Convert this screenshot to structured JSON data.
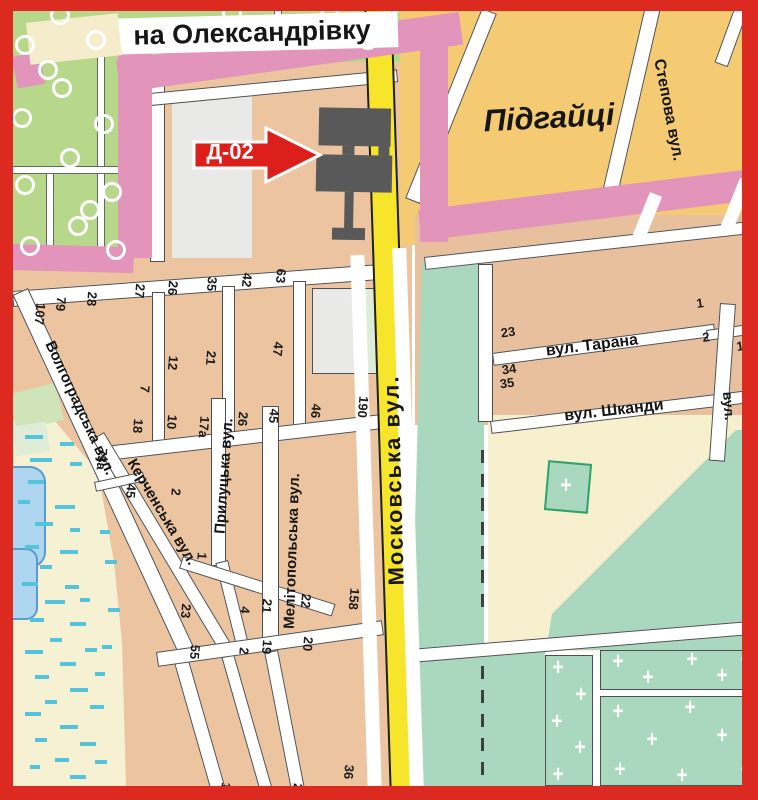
{
  "billboard": {
    "code": "Д-02"
  },
  "labels": [
    {
      "t": "на Олександрівку",
      "x": 252,
      "y": 33,
      "r": -1.5,
      "s": 27
    },
    {
      "t": "Підгайці",
      "x": 549,
      "y": 118,
      "r": -3,
      "s": 31,
      "i": 1
    },
    {
      "t": "Степова вул.",
      "x": 668,
      "y": 110,
      "r": 79,
      "s": 16
    },
    {
      "t": "Московська вул.",
      "x": 394,
      "y": 480,
      "r": -91.5,
      "s": 22,
      "ls": 2
    },
    {
      "t": "вул. Тарана",
      "x": 592,
      "y": 346,
      "r": -7,
      "s": 16
    },
    {
      "t": "вул. Шканди",
      "x": 614,
      "y": 411,
      "r": -6.5,
      "s": 16
    },
    {
      "t": "вул.",
      "x": 729,
      "y": 406,
      "r": 86,
      "s": 14
    },
    {
      "t": "Волгоградська вул.",
      "x": 80,
      "y": 408,
      "r": 65,
      "s": 15
    },
    {
      "t": "Керченська вул.",
      "x": 162,
      "y": 512,
      "r": 59,
      "s": 15
    },
    {
      "t": "Прилуцька вул.",
      "x": 224,
      "y": 476,
      "r": -86,
      "s": 15
    },
    {
      "t": "Мелітопольська вул.",
      "x": 292,
      "y": 551,
      "r": -88,
      "s": 15
    }
  ],
  "house_numbers": [
    {
      "t": "107",
      "x": 40,
      "y": 314
    },
    {
      "t": "79",
      "x": 61,
      "y": 304
    },
    {
      "t": "28",
      "x": 92,
      "y": 299
    },
    {
      "t": "27",
      "x": 140,
      "y": 291
    },
    {
      "t": "26",
      "x": 173,
      "y": 288
    },
    {
      "t": "35",
      "x": 212,
      "y": 284
    },
    {
      "t": "42",
      "x": 247,
      "y": 280
    },
    {
      "t": "63",
      "x": 281,
      "y": 276
    },
    {
      "t": "7",
      "x": 145,
      "y": 389
    },
    {
      "t": "12",
      "x": 173,
      "y": 363
    },
    {
      "t": "21",
      "x": 211,
      "y": 358
    },
    {
      "t": "47",
      "x": 278,
      "y": 349
    },
    {
      "t": "18",
      "x": 138,
      "y": 426
    },
    {
      "t": "10",
      "x": 172,
      "y": 422
    },
    {
      "t": "17а",
      "x": 204,
      "y": 427
    },
    {
      "t": "26",
      "x": 243,
      "y": 419
    },
    {
      "t": "45",
      "x": 274,
      "y": 416
    },
    {
      "t": "46",
      "x": 316,
      "y": 411
    },
    {
      "t": "190",
      "x": 363,
      "y": 407
    },
    {
      "t": "73а",
      "x": 102,
      "y": 459
    },
    {
      "t": "45",
      "x": 131,
      "y": 491
    },
    {
      "t": "2",
      "x": 176,
      "y": 492
    },
    {
      "t": "1",
      "x": 202,
      "y": 556
    },
    {
      "t": "23",
      "x": 186,
      "y": 611
    },
    {
      "t": "4",
      "x": 245,
      "y": 610
    },
    {
      "t": "21",
      "x": 267,
      "y": 606
    },
    {
      "t": "22",
      "x": 306,
      "y": 601
    },
    {
      "t": "158",
      "x": 354,
      "y": 599
    },
    {
      "t": "55",
      "x": 195,
      "y": 652
    },
    {
      "t": "2",
      "x": 244,
      "y": 651
    },
    {
      "t": "19",
      "x": 267,
      "y": 647
    },
    {
      "t": "20",
      "x": 308,
      "y": 644
    },
    {
      "t": "36",
      "x": 349,
      "y": 772
    },
    {
      "t": "1",
      "x": 226,
      "y": 786
    },
    {
      "t": "2",
      "x": 298,
      "y": 787
    },
    {
      "t": "23",
      "x": 508,
      "y": 332,
      "r": -8
    },
    {
      "t": "1",
      "x": 700,
      "y": 303,
      "r": -8
    },
    {
      "t": "2",
      "x": 706,
      "y": 337,
      "r": -8
    },
    {
      "t": "34",
      "x": 509,
      "y": 369,
      "r": -8
    },
    {
      "t": "35",
      "x": 507,
      "y": 383,
      "r": -8
    },
    {
      "t": "1",
      "x": 740,
      "y": 346,
      "r": -8
    }
  ],
  "decor": {
    "trees": [
      [
        25,
        45
      ],
      [
        60,
        15
      ],
      [
        96,
        40
      ],
      [
        22,
        118
      ],
      [
        62,
        88
      ],
      [
        104,
        124
      ],
      [
        25,
        185
      ],
      [
        70,
        158
      ],
      [
        112,
        192
      ],
      [
        30,
        246
      ],
      [
        78,
        226
      ],
      [
        116,
        250
      ],
      [
        48,
        70
      ],
      [
        90,
        210
      ],
      [
        185,
        30
      ],
      [
        232,
        13
      ],
      [
        280,
        36
      ],
      [
        330,
        16
      ],
      [
        368,
        40
      ]
    ],
    "marsh_dashes": [
      [
        25,
        435,
        18
      ],
      [
        60,
        442,
        14
      ],
      [
        30,
        458,
        22
      ],
      [
        70,
        462,
        12
      ],
      [
        28,
        480,
        16
      ],
      [
        18,
        500,
        12
      ],
      [
        55,
        505,
        20
      ],
      [
        35,
        522,
        18
      ],
      [
        70,
        528,
        10
      ],
      [
        25,
        545,
        14
      ],
      [
        60,
        550,
        18
      ],
      [
        100,
        530,
        10
      ],
      [
        40,
        565,
        12
      ],
      [
        105,
        560,
        12
      ],
      [
        22,
        582,
        16
      ],
      [
        65,
        585,
        14
      ],
      [
        45,
        600,
        20
      ],
      [
        80,
        598,
        10
      ],
      [
        108,
        608,
        12
      ],
      [
        30,
        618,
        14
      ],
      [
        70,
        622,
        16
      ],
      [
        102,
        645,
        10
      ],
      [
        50,
        638,
        12
      ],
      [
        25,
        650,
        18
      ],
      [
        85,
        648,
        12
      ],
      [
        60,
        662,
        16
      ],
      [
        35,
        675,
        14
      ],
      [
        95,
        672,
        10
      ],
      [
        70,
        688,
        18
      ],
      [
        45,
        700,
        12
      ],
      [
        25,
        712,
        16
      ],
      [
        90,
        705,
        14
      ],
      [
        60,
        725,
        18
      ],
      [
        35,
        738,
        12
      ],
      [
        80,
        742,
        16
      ],
      [
        55,
        758,
        14
      ],
      [
        30,
        765,
        10
      ],
      [
        95,
        760,
        12
      ],
      [
        70,
        775,
        16
      ],
      [
        45,
        786,
        10
      ]
    ],
    "crosses": [
      [
        566,
        486
      ],
      [
        558,
        668
      ],
      [
        581,
        695
      ],
      [
        557,
        722
      ],
      [
        580,
        748
      ],
      [
        558,
        775
      ],
      [
        618,
        662
      ],
      [
        648,
        678
      ],
      [
        692,
        660
      ],
      [
        722,
        676
      ],
      [
        746,
        660
      ],
      [
        618,
        712
      ],
      [
        690,
        708
      ],
      [
        748,
        712
      ],
      [
        652,
        740
      ],
      [
        722,
        736
      ],
      [
        620,
        770
      ],
      [
        682,
        776
      ],
      [
        746,
        770
      ]
    ]
  },
  "colors": {
    "frame": "#dc2a20",
    "pink": "#e294bb",
    "road_yellow": "#f7e52b",
    "district_orange": "#f4cb73",
    "blocks_tan": "#ecc5a0",
    "blocks_tan_right": "#e9c09e",
    "orchard_green": "#b7d88b",
    "park_teal": "#a9d8bf",
    "cream": "#f7f0cf",
    "marsh": "#f7f1d4",
    "gray_block": "#e9e9e7",
    "water": "#aed6f1",
    "water_edge": "#5a9bd0",
    "marsh_dash": "#54c3dc",
    "street_edge": "#4f4f4f",
    "billboard_gray": "#595959",
    "arrow_red": "#dc1f1a",
    "pale_green": "#dfecd7",
    "chapel_green": "#2fa36b"
  }
}
